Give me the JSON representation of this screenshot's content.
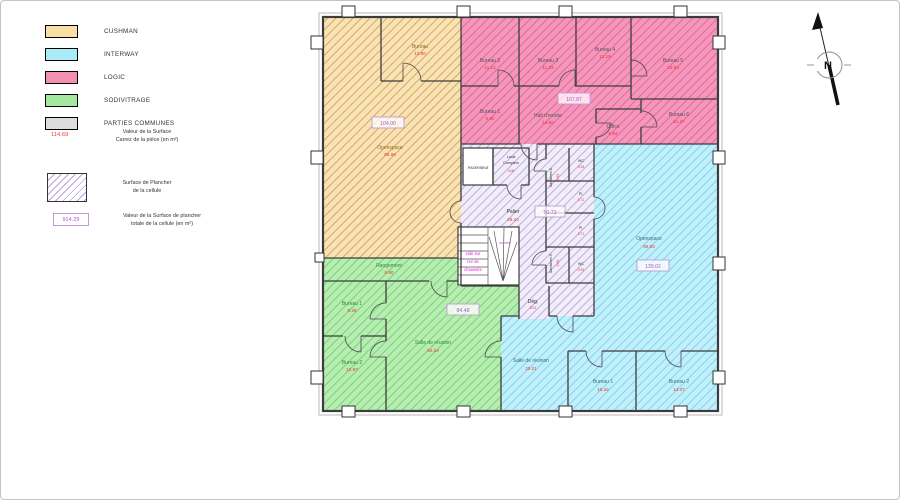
{
  "legend": {
    "items": [
      {
        "label": "CUSHMAN",
        "color": "#F9DFA4"
      },
      {
        "label": "INTERWAY",
        "color": "#A9ECF7"
      },
      {
        "label": "LOGIC",
        "color": "#F48FB4"
      },
      {
        "label": "SODIVITRAGE",
        "color": "#A4E8A0"
      },
      {
        "label": "PARTIES COMMUNES",
        "color": "#DDDDDD"
      }
    ],
    "carrez": {
      "value": "114.69",
      "line1": "Valeur de la Surface",
      "line2": "Carrez de la pièce (en m²)"
    },
    "plancher": {
      "line1": "Surface de Plancher",
      "line2": "de la cellule"
    },
    "plancher_total": {
      "value": "914.29",
      "line1": "Valeur de la Surface de plancher",
      "line2": "totale de la cellule (en m²)"
    }
  },
  "compass": {
    "label": "N"
  },
  "colors": {
    "carrez_value": "#F4332B",
    "plancher_value": "#B356C9",
    "wall": "#3C3C3C"
  },
  "plan": {
    "cushman": {
      "bureau": {
        "name": "Bureau",
        "area": "13.90"
      },
      "openspace": {
        "name": "Openspace",
        "area": "86.96"
      },
      "total": "104.00"
    },
    "logic": {
      "bureau1": {
        "name": "Bureau 1",
        "area": "9.90"
      },
      "bureau2": {
        "name": "Bureau 2",
        "area": "11.13"
      },
      "bureau3": {
        "name": "Bureau 3",
        "area": "11.33"
      },
      "bureau4": {
        "name": "Bureau 4",
        "area": "12.19"
      },
      "bureau5": {
        "name": "Bureau 5",
        "area": "10.83"
      },
      "bureau6": {
        "name": "Bureau 6",
        "area": "11.27"
      },
      "hall": {
        "name": "Hall d'entrée",
        "area": "16.50"
      },
      "office": {
        "name": "Office",
        "area": "5.84"
      },
      "total": "107.87"
    },
    "interway": {
      "openspace": {
        "name": "Openspace",
        "area": "90.83"
      },
      "salle": {
        "name": "Salle de réunion",
        "area": "20.21"
      },
      "bureau1": {
        "name": "Bureau 1",
        "area": "10.42"
      },
      "bureau2": {
        "name": "Bureau 2",
        "area": "14.07"
      },
      "total": "139.02"
    },
    "sodivitrage": {
      "rangement": {
        "name": "Rangement",
        "area": "8.90"
      },
      "bureau1": {
        "name": "Bureau 1",
        "area": "8.26"
      },
      "bureau2": {
        "name": "Bureau 2",
        "area": "13.87"
      },
      "salle": {
        "name": "Salle de réunion",
        "area": "50.24"
      },
      "total": "84.48"
    },
    "communs": {
      "ascenseur": {
        "name": "Ascenseur"
      },
      "local_compteur": {
        "line1": "Local",
        "line2": "Compteur",
        "area": "4.06"
      },
      "palier": {
        "name": "Palier",
        "area": "28.44"
      },
      "sanitaires_d": {
        "name": "Sanitaires D.",
        "area": "2.63"
      },
      "sanitaires_h": {
        "name": "Sanitaires H.",
        "area": "2.63"
      },
      "wc_d": {
        "name": "WC",
        "area": "0.93"
      },
      "pl_d": {
        "name": "Pl.",
        "area": "0.71"
      },
      "pl_h": {
        "name": "Pl.",
        "area": "0.71"
      },
      "wc_h": {
        "name": "WC",
        "area": "0.93"
      },
      "deg": {
        "name": "Dég.",
        "area": "5.01"
      },
      "stairs_note": {
        "line1": "vide sur",
        "line2": "rez de",
        "line3": "chaussée"
      },
      "montee": "montée",
      "total": "50.73"
    }
  }
}
